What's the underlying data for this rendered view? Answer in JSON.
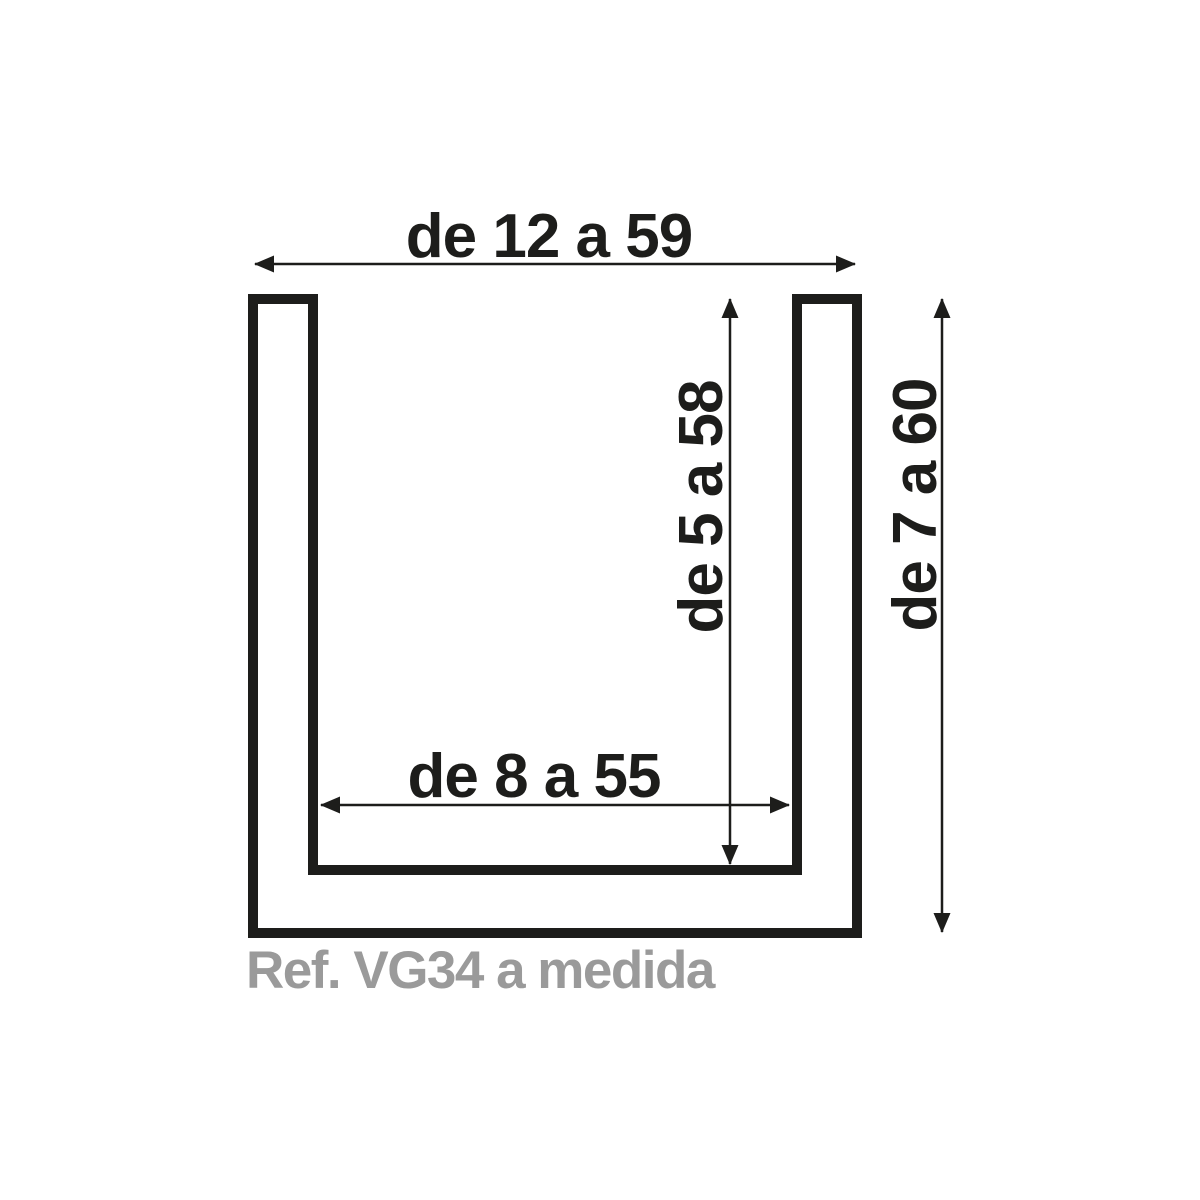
{
  "diagram": {
    "type": "technical-profile-cross-section",
    "shape": "u-channel",
    "reference_label": "Ref. VG34 a medida",
    "dimensions": {
      "outer_width_label": "de 12 a 59",
      "inner_depth_label": "de 5 a 58",
      "outer_height_label": "de 7 a 60",
      "inner_width_label": "de 8 a 55"
    },
    "colors": {
      "line": "#1d1d1b",
      "dimension_text": "#1d1d1b",
      "reference_text": "#9a9a9a",
      "background": "#ffffff"
    }
  }
}
